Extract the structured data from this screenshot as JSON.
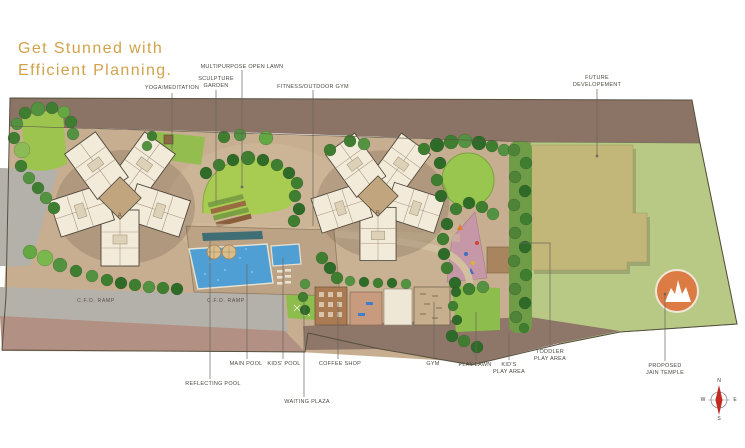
{
  "title": {
    "line1": "Get Stunned with",
    "line2": "Efficient Planning."
  },
  "plan_labels": {
    "yoga_meditation": "YOGA/MEDITATION",
    "sculpture_garden": "SCULPTURE\nGARDEN",
    "multipurpose_open_lawn": "MULTIPURPOSE OPEN LAWN",
    "fitness_outdoor_gym": "FITNESS/OUTDOOR GYM",
    "future_development": "FUTURE\nDEVELOPEMENT",
    "reflecting_pool": "REFLECTING POOL",
    "main_pool": "MAIN POOL",
    "kids_pool": "KIDS' POOL",
    "coffee_shop": "COFFEE SHOP",
    "waiting_plaza": "WAITING PLAZA",
    "gym": "GYM",
    "play_lawn": "PLAY LAWN",
    "kids_play_area": "KID'S\nPLAY AREA",
    "toddler_play_area": "TODDLER\nPLAY AREA",
    "proposed_jain_temple": "PROPOSED\nJAIN TEMPLE",
    "cfo_ramp_1": "C.F.O. RAMP",
    "cfo_ramp_2": "C.F.O. RAMP"
  },
  "buildings": {
    "tower_a": "A",
    "tower_b": "B"
  },
  "compass": {
    "n": "N",
    "e": "E",
    "s": "S",
    "w": "W"
  },
  "palette": {
    "title_gold": "#d2a24b",
    "hardscape_tan": "#c7ae90",
    "boundary_brown": "#8b7366",
    "lawn_green": "#9cc44f",
    "future_dev_green": "#b8c985",
    "pool_blue": "#4f9fd4",
    "temple_orange": "#dd7b44",
    "kids_area_pink": "#c697a6"
  }
}
